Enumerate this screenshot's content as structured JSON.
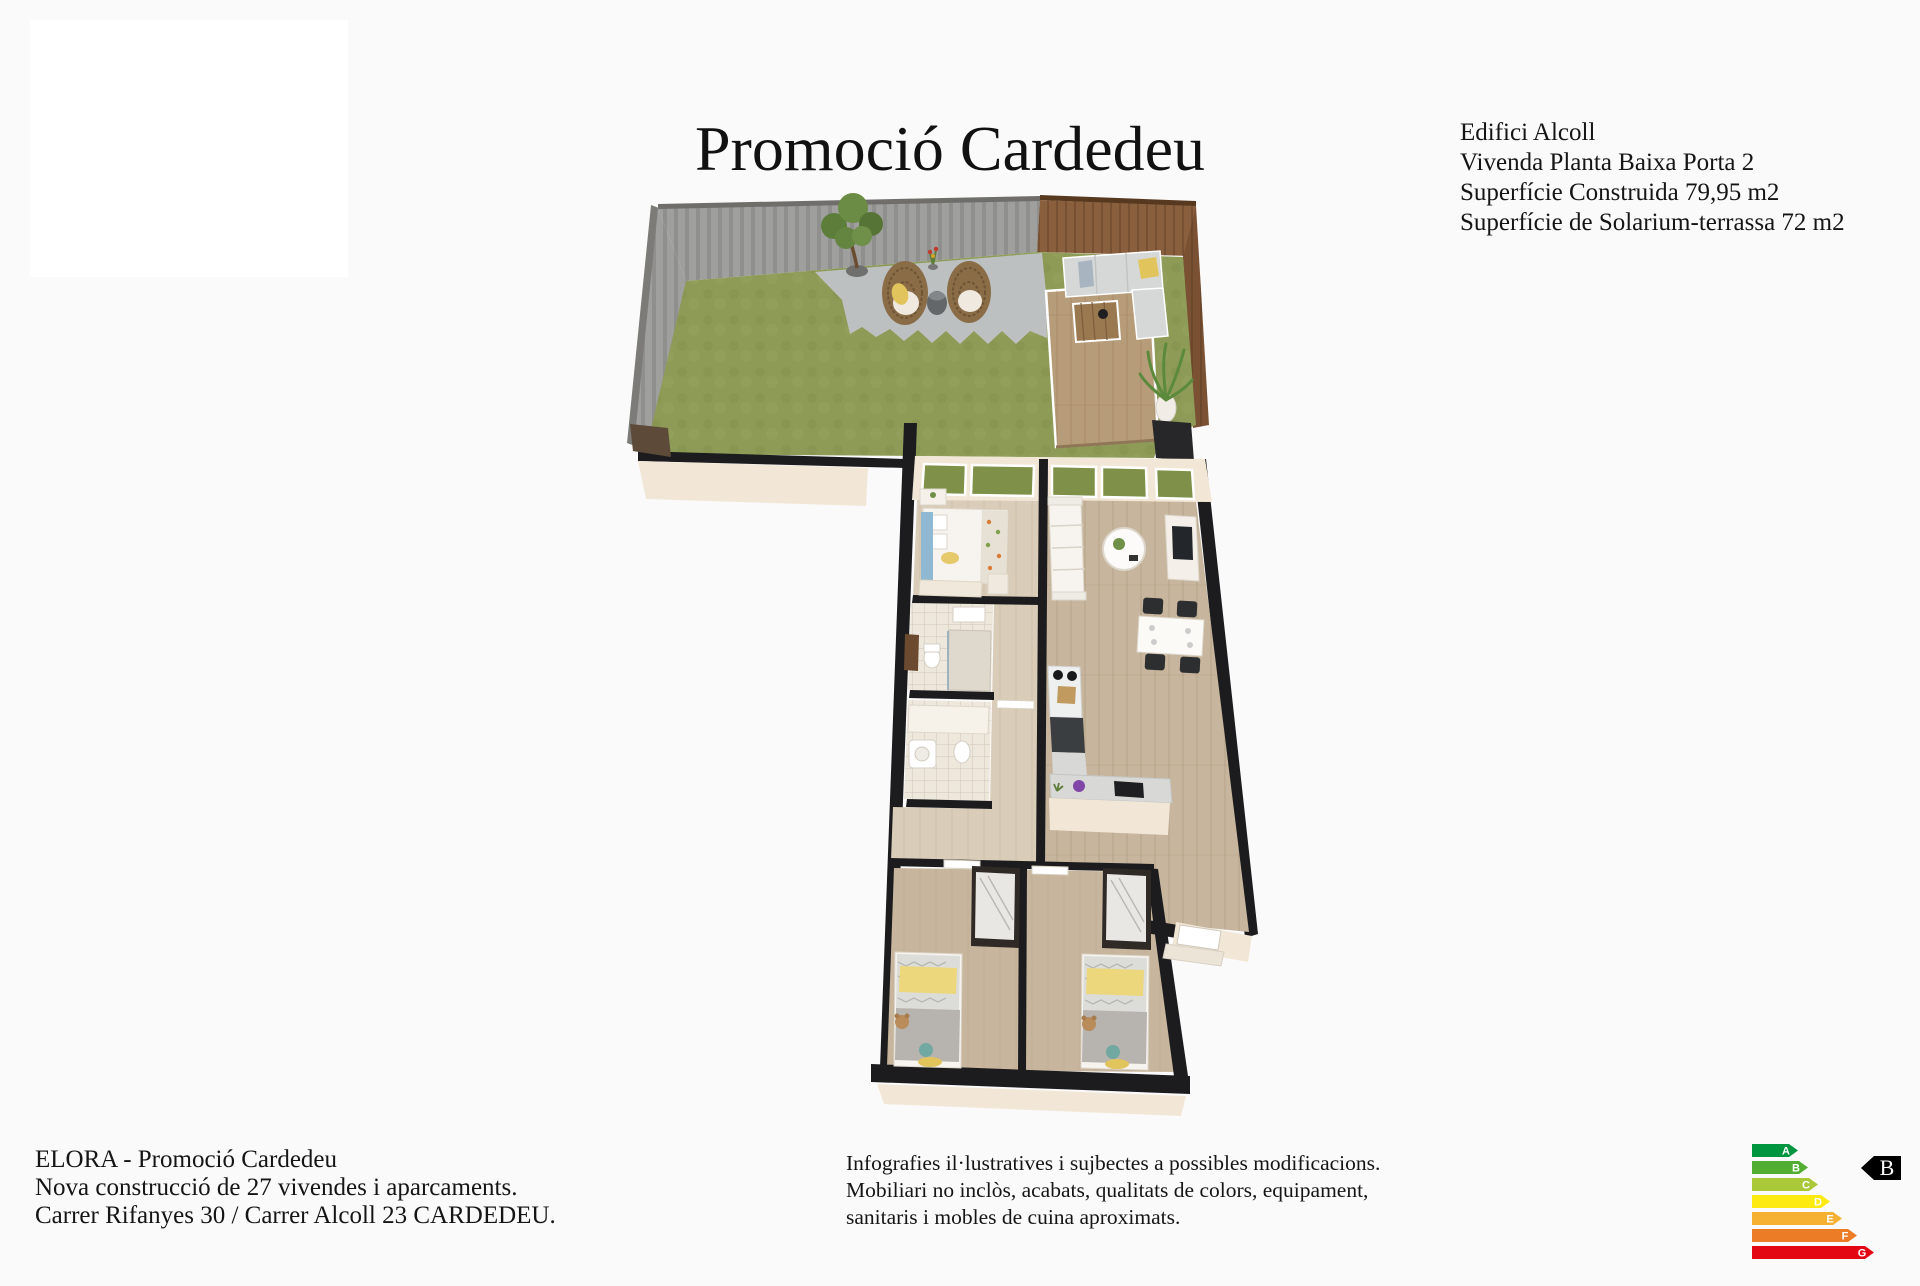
{
  "page": {
    "background_color": "#fafafa"
  },
  "title": "Promoció Cardedeu",
  "property_info": {
    "lines": [
      "Edifici Alcoll",
      "Vivenda Planta Baixa Porta 2",
      "Superfície Construida 79,95 m2",
      "Superfície de Solarium-terrassa 72 m2"
    ]
  },
  "developer_info": {
    "lines": [
      "ELORA - Promoció Cardedeu",
      "Nova construcció de 27 vivendes i aparcaments.",
      "Carrer Rifanyes 30 / Carrer Alcoll 23 CARDEDEU."
    ]
  },
  "disclaimer": {
    "lines": [
      "Infografies il·lustratives i sujbectes a possibles modificacions.",
      "Mobiliari no inclòs, acabats, qualitats de colors, equipament,",
      "sanitaris i mobles de cuina aproximats."
    ]
  },
  "energy_label": {
    "rating": "B",
    "letter_color": "#ffffff",
    "pointer_color": "#000000",
    "pointer_text_color": "#ffffff",
    "scale": [
      {
        "letter": "A",
        "color": "#009640",
        "width": 46
      },
      {
        "letter": "B",
        "color": "#52ae32",
        "width": 56
      },
      {
        "letter": "C",
        "color": "#a9c938",
        "width": 66
      },
      {
        "letter": "D",
        "color": "#fdea11",
        "width": 78
      },
      {
        "letter": "E",
        "color": "#f6b133",
        "width": 90
      },
      {
        "letter": "F",
        "color": "#ec7c25",
        "width": 105
      },
      {
        "letter": "G",
        "color": "#e30613",
        "width": 122
      }
    ]
  },
  "floor_plan": {
    "palette": {
      "grass": "#8e9b57",
      "wall_concrete": "#9f9f9d",
      "wood_fence": "#8a5f3e",
      "deck_wood": "#b79c79",
      "paving": "#bcc0c1",
      "wall_cut": "#1c1c1e",
      "wall_face": "#f2e7d6",
      "floor_living": "#c7b69d",
      "floor_bedroom": "#d9ccb8",
      "floor_bath": "#eee7db",
      "counter_dark": "#3b3e40",
      "accent_yellow": "#e2c45c",
      "window_green": "#7f9148"
    }
  }
}
